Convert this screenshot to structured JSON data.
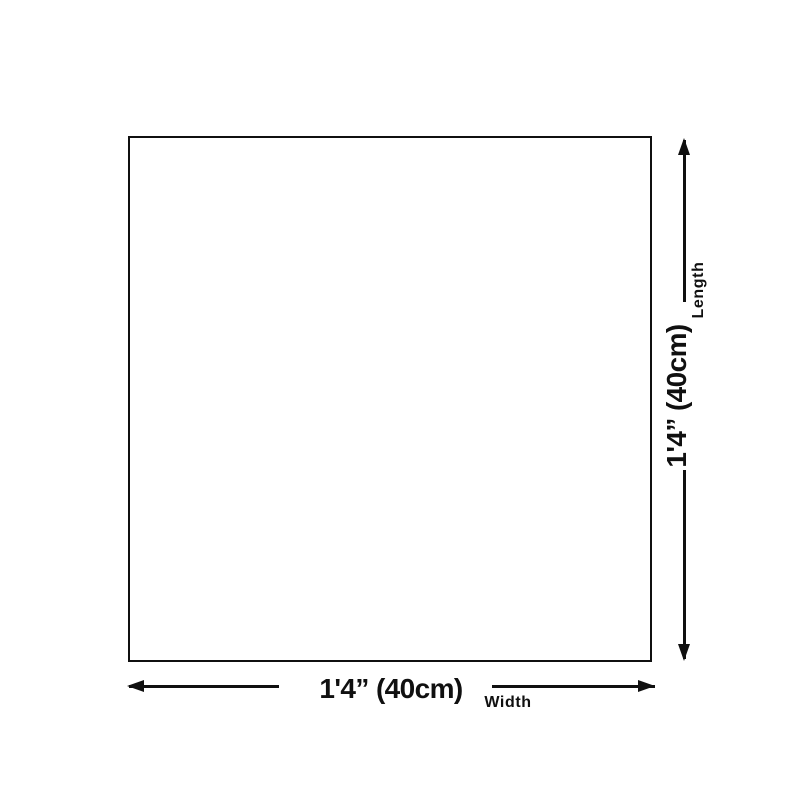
{
  "diagram": {
    "length_value": "1'4” (40cm)",
    "length_label": "Length",
    "width_value": "1'4” (40cm)",
    "width_label": "Width"
  },
  "colors": {
    "ink": "#101010",
    "background": "#ffffff"
  }
}
